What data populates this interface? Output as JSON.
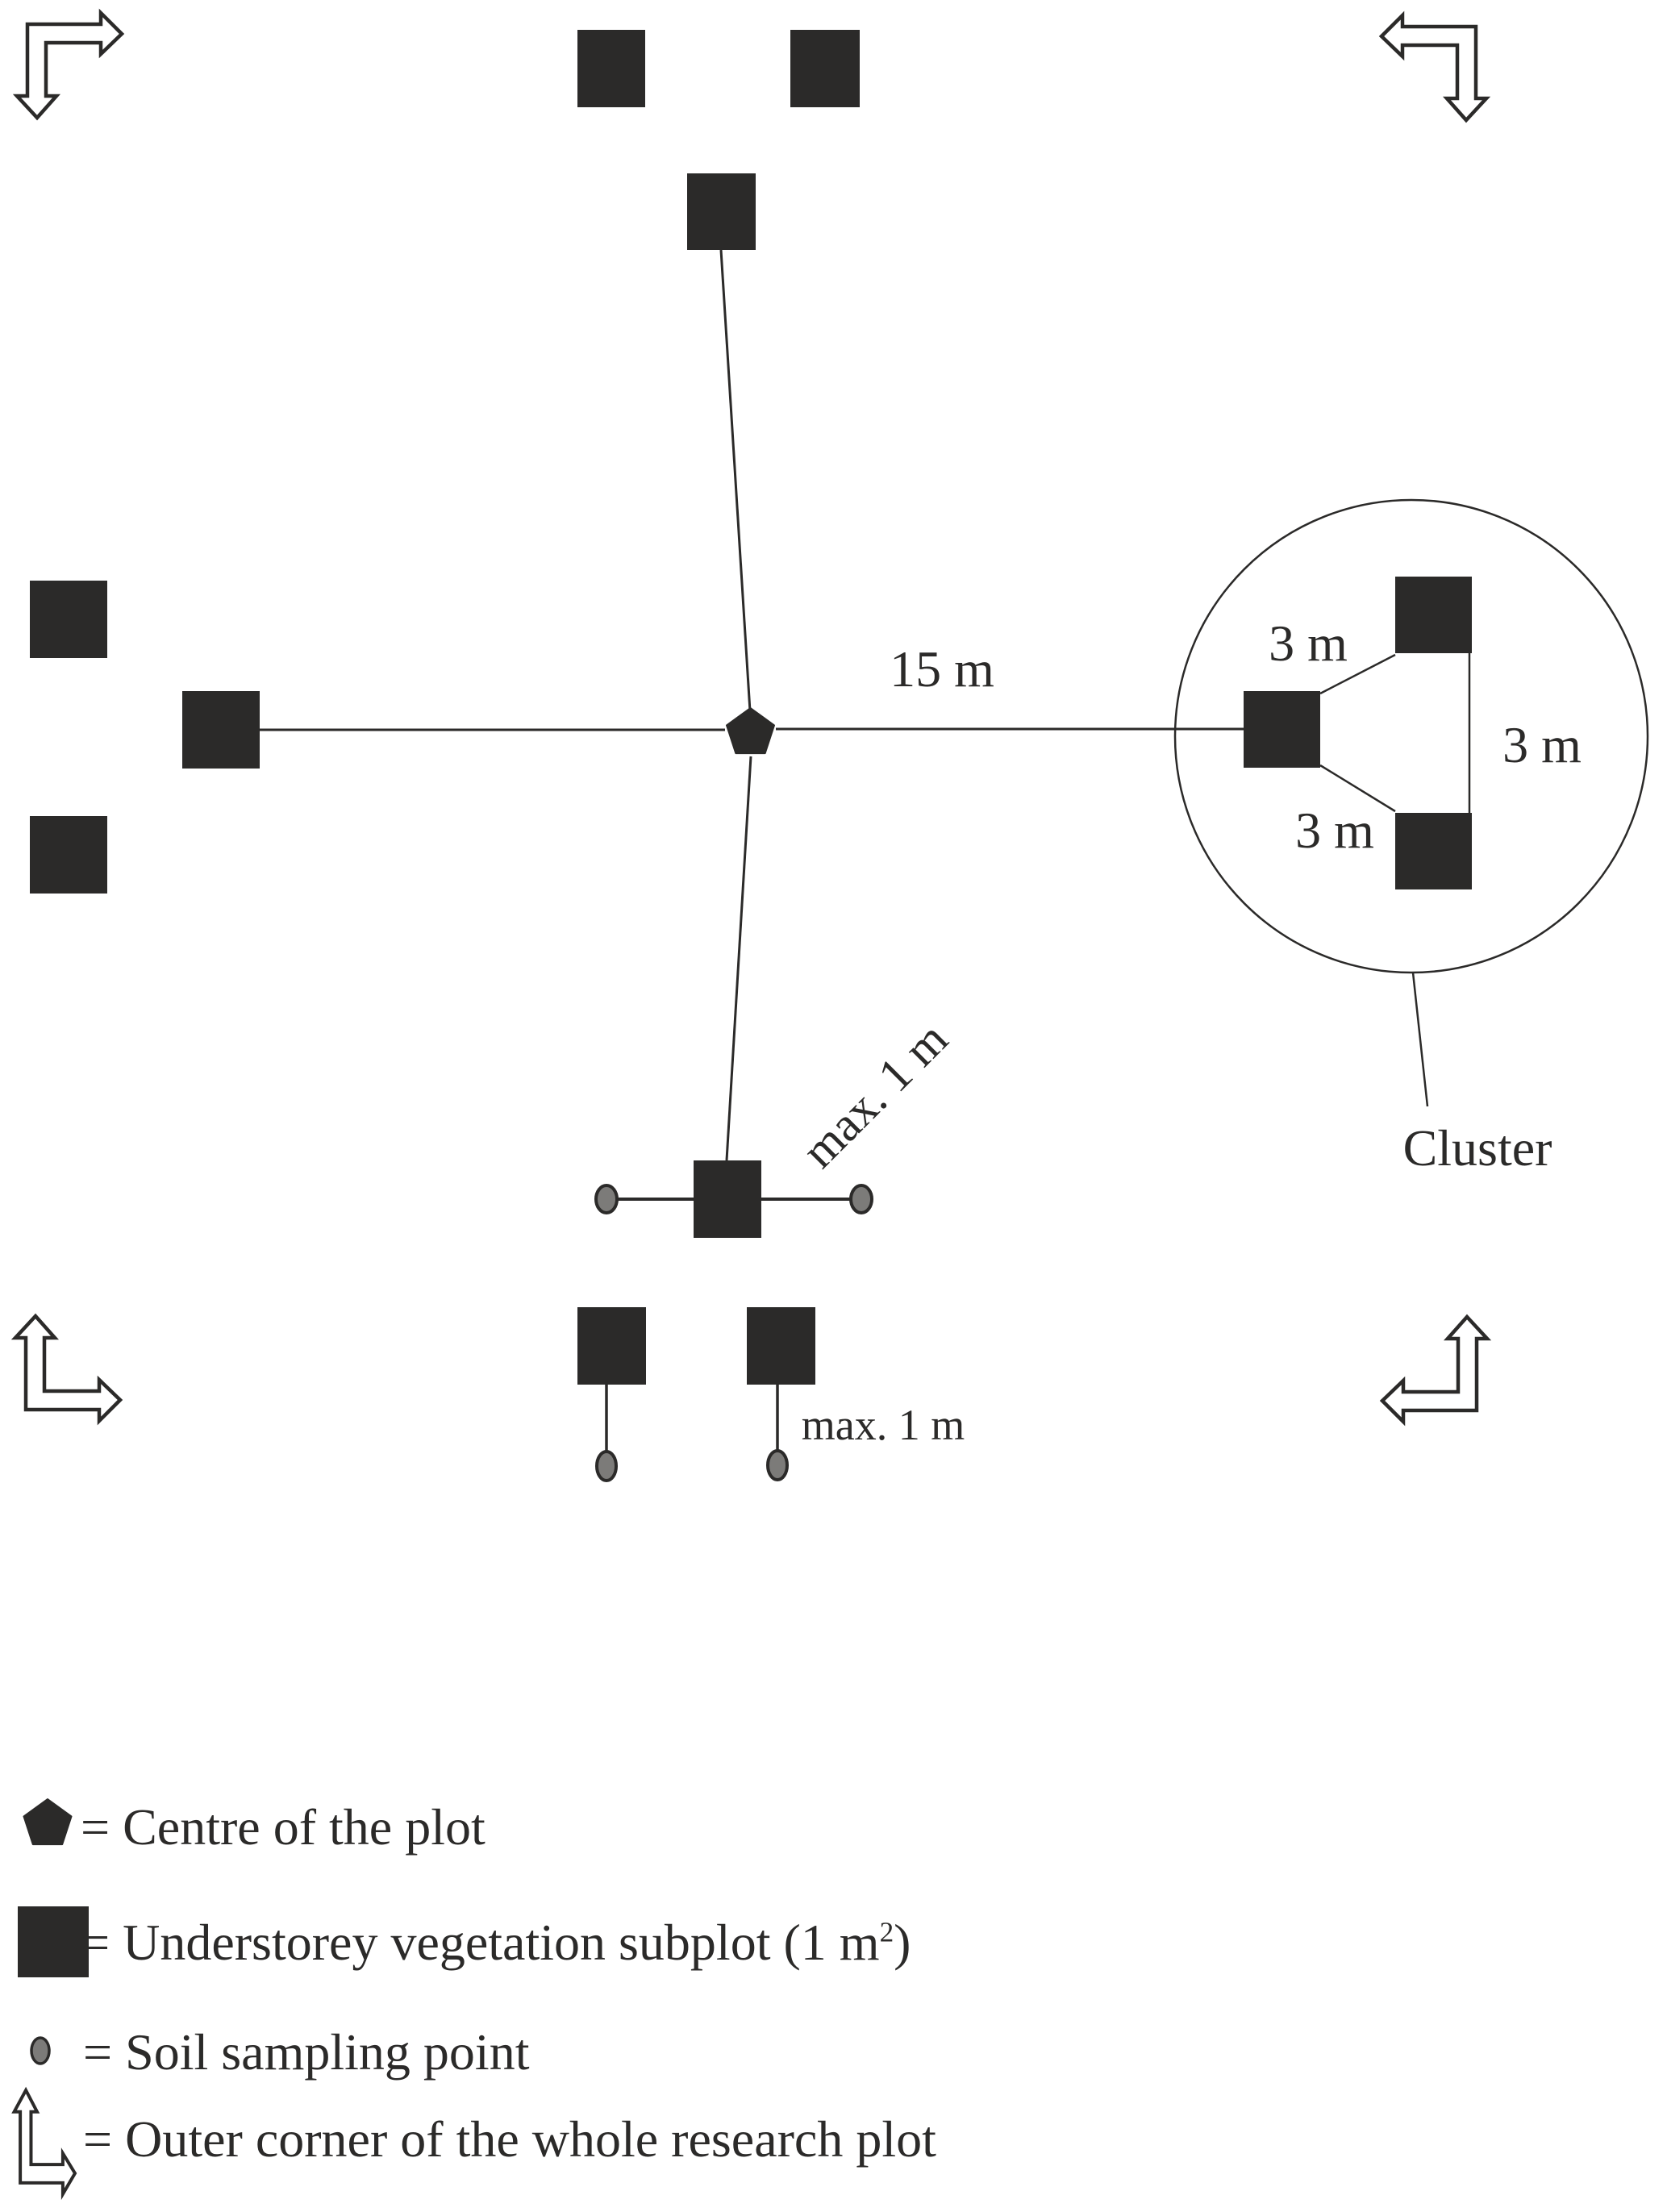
{
  "labels": {
    "dist_15m": "15 m",
    "dist_3m_top": "3 m",
    "dist_3m_right": "3 m",
    "dist_3m_bottom": "3 m",
    "cluster": "Cluster",
    "max_1m_diagonal": "max. 1 m",
    "max_1m_bottom": "max. 1 m"
  },
  "legend": {
    "centre": {
      "symbol": "pentagon",
      "label": "= Centre of the plot"
    },
    "subplot": {
      "symbol": "square",
      "prefix": "= Understorey vegetation subplot (1 m",
      "sup": "2",
      "suffix": ")"
    },
    "soil": {
      "symbol": "soil-point",
      "label": "= Soil sampling point"
    },
    "corner": {
      "symbol": "corner-arrow",
      "label": "= Outer corner of the whole research plot"
    }
  },
  "colors": {
    "ink": "#2b2a29",
    "soil_fill": "#7c7b79",
    "background": "#ffffff"
  }
}
